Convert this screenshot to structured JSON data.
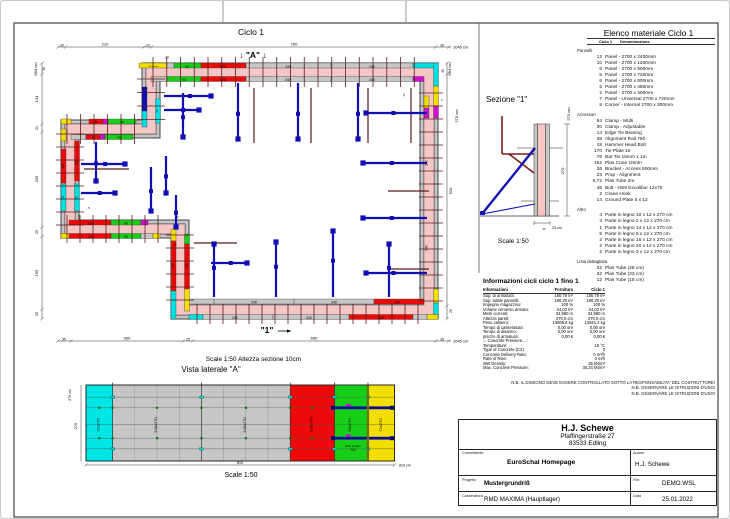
{
  "plan": {
    "title": "Ciclo 1",
    "scale_line": "Scale 1:50   Altezza sezione 10cm",
    "vista_title": "Vista laterale \"A\"",
    "labels": [
      {
        "x": 61,
        "y": 45.5,
        "t": "20",
        "s": 3.4
      },
      {
        "x": 104,
        "y": 44.5,
        "t": "210",
        "s": 4
      },
      {
        "x": 147,
        "y": 45.5,
        "t": "20",
        "s": 3.4
      },
      {
        "x": 293,
        "y": 44.5,
        "t": "760",
        "s": 4
      },
      {
        "x": 441,
        "y": 45.5,
        "t": "35",
        "s": 3.4
      },
      {
        "x": 452,
        "y": 47.5,
        "t": "1045 cm",
        "s": 4,
        "a": "s"
      },
      {
        "x": 252,
        "y": 57,
        "t": "↓ \"A\" ↓",
        "s": 8.5,
        "w": "b"
      },
      {
        "x": 166,
        "y": 57.5,
        "t": "10",
        "s": 3.4
      },
      {
        "x": 36,
        "y": 68,
        "t": "684 cm",
        "s": 4,
        "r": 1
      },
      {
        "x": 44,
        "y": 68,
        "t": "30",
        "s": 3.2,
        "r": 1
      },
      {
        "x": 37,
        "y": 98,
        "t": "134",
        "s": 4,
        "r": 1
      },
      {
        "x": 37,
        "y": 127,
        "t": "20",
        "s": 3.4,
        "r": 1
      },
      {
        "x": 37,
        "y": 178,
        "t": "255",
        "s": 4,
        "r": 1
      },
      {
        "x": 37,
        "y": 231,
        "t": "25",
        "s": 3.4,
        "r": 1
      },
      {
        "x": 37,
        "y": 272,
        "t": "195",
        "s": 4,
        "r": 1
      },
      {
        "x": 37,
        "y": 313,
        "t": "25",
        "s": 3.4,
        "r": 1
      },
      {
        "x": 450,
        "y": 68,
        "t": "684 cm",
        "s": 4,
        "r": 1
      },
      {
        "x": 443,
        "y": 70,
        "t": "30",
        "s": 3.2,
        "r": 1
      },
      {
        "x": 457,
        "y": 115,
        "t": "270 cm",
        "s": 4,
        "r": 1
      },
      {
        "x": 451,
        "y": 190,
        "t": "620",
        "s": 4,
        "r": 1
      },
      {
        "x": 451,
        "y": 310,
        "t": "25",
        "s": 3.4,
        "r": 1
      },
      {
        "x": 63,
        "y": 339.5,
        "t": "35",
        "s": 3.4
      },
      {
        "x": 126,
        "y": 338.5,
        "t": "300",
        "s": 4
      },
      {
        "x": 187,
        "y": 339.5,
        "t": "25",
        "s": 3.4
      },
      {
        "x": 313,
        "y": 338.5,
        "t": "650",
        "s": 4
      },
      {
        "x": 441,
        "y": 339.5,
        "t": "35",
        "s": 3.4
      },
      {
        "x": 452,
        "y": 341.5,
        "t": "1045 cm",
        "s": 4,
        "a": "s"
      },
      {
        "x": 266,
        "y": 332,
        "t": "\"1\"",
        "s": 8.5,
        "w": "b"
      },
      {
        "x": 287,
        "y": 66.8,
        "t": "240",
        "s": 3.4
      },
      {
        "x": 371,
        "y": 66.8,
        "t": "240",
        "s": 3.4
      },
      {
        "x": 222,
        "y": 66.8,
        "t": "120",
        "s": 3.4
      },
      {
        "x": 186,
        "y": 66.8,
        "t": "90",
        "s": 3.4
      },
      {
        "x": 287,
        "y": 79.8,
        "t": "240",
        "s": 3.4
      },
      {
        "x": 371,
        "y": 79.8,
        "t": "240",
        "s": 3.4
      },
      {
        "x": 222,
        "y": 79.8,
        "t": "120",
        "s": 3.4
      },
      {
        "x": 183,
        "y": 79.8,
        "t": "90",
        "s": 3.4
      },
      {
        "x": 234,
        "y": 318.2,
        "t": "240",
        "s": 3.4
      },
      {
        "x": 308,
        "y": 318.2,
        "t": "240",
        "s": 3.4
      },
      {
        "x": 380,
        "y": 318.2,
        "t": "120",
        "s": 3.4
      },
      {
        "x": 253,
        "y": 302.5,
        "t": "240",
        "s": 3.4
      },
      {
        "x": 333,
        "y": 302.5,
        "t": "240",
        "s": 3.4
      },
      {
        "x": 396,
        "y": 302.5,
        "t": "120",
        "s": 3.4
      },
      {
        "x": 426.5,
        "y": 162,
        "t": "240",
        "s": 3.4,
        "r": 1
      },
      {
        "x": 426.5,
        "y": 247,
        "t": "240",
        "s": 3.4,
        "r": 1
      },
      {
        "x": 89,
        "y": 223.5,
        "t": "120",
        "s": 3.2
      },
      {
        "x": 125,
        "y": 223.5,
        "t": "90",
        "s": 3.2
      },
      {
        "x": 89,
        "y": 237,
        "t": "120",
        "s": 3.2
      },
      {
        "x": 125,
        "y": 237,
        "t": "90",
        "s": 3.2
      },
      {
        "x": 63,
        "y": 165,
        "t": "120",
        "s": 3.2,
        "r": 1
      },
      {
        "x": 76.5,
        "y": 162,
        "t": "120",
        "s": 3.2,
        "r": 1
      },
      {
        "x": 63,
        "y": 197,
        "t": "72",
        "s": 3.2,
        "r": 1
      },
      {
        "x": 76.5,
        "y": 197,
        "t": "72",
        "s": 3.2,
        "r": 1
      },
      {
        "x": 173,
        "y": 265,
        "t": "120",
        "s": 3.2,
        "r": 1
      },
      {
        "x": 186.5,
        "y": 265,
        "t": "120",
        "s": 3.2,
        "r": 1
      },
      {
        "x": 95,
        "y": 122,
        "t": "45",
        "s": 3
      },
      {
        "x": 121,
        "y": 122,
        "t": "90",
        "s": 3
      },
      {
        "x": 92,
        "y": 137.3,
        "t": "45",
        "s": 3
      },
      {
        "x": 118,
        "y": 137.3,
        "t": "90",
        "s": 3
      },
      {
        "x": 404,
        "y": 94,
        "t": "14",
        "s": 3,
        "r": 1
      },
      {
        "x": 441,
        "y": 100,
        "t": "2",
        "s": 3
      },
      {
        "x": 176,
        "y": 217,
        "t": "26",
        "s": 3
      },
      {
        "x": 88,
        "y": 208,
        "t": "5",
        "s": 3
      },
      {
        "x": 174,
        "y": 244.5,
        "t": "20",
        "s": 3
      },
      {
        "x": 157,
        "y": 110,
        "t": "72",
        "s": 3,
        "r": 1
      },
      {
        "x": 152,
        "y": 65.8,
        "t": "Universal",
        "s": 2.2
      }
    ]
  },
  "sezione": {
    "title": "Sezione \"1\"",
    "scale": "Scale 1:50",
    "labels": [
      {
        "x": 569,
        "y": 113,
        "t": "270 cm",
        "s": 4,
        "r": 1
      },
      {
        "x": 563,
        "y": 170,
        "t": "270",
        "s": 4,
        "r": 1
      },
      {
        "x": 551,
        "y": 228,
        "t": "25 cm",
        "s": 3.6,
        "a": "s"
      },
      {
        "x": 543,
        "y": 229,
        "t": "35",
        "s": 2.8
      }
    ]
  },
  "side_view": {
    "panels": [
      {
        "w": 72,
        "label": "72x270",
        "color": "#00e6e6"
      },
      {
        "w": 240,
        "label": "240x270",
        "color": "#c6c6c6",
        "sub": true
      },
      {
        "w": 240,
        "label": "240x270",
        "color": "#c6c6c6",
        "sub": true
      },
      {
        "w": 120,
        "label": "120x270",
        "color": "#ee0909"
      },
      {
        "w": 90,
        "label": "90x270",
        "color": "#17cf17"
      },
      {
        "w": 72,
        "label": "72x270",
        "color": "#f2de00"
      }
    ],
    "scale": "Scale 1:50",
    "labels": [
      {
        "x": 98.3,
        "y": 424,
        "t": "72x270",
        "s": 4,
        "r": 1
      },
      {
        "x": 156,
        "y": 424,
        "t": "240x270",
        "s": 4,
        "r": 1
      },
      {
        "x": 244.8,
        "y": 424,
        "t": "240x270",
        "s": 4,
        "r": 1
      },
      {
        "x": 311.4,
        "y": 424,
        "t": "120x270",
        "s": 4,
        "r": 1
      },
      {
        "x": 350.2,
        "y": 424,
        "t": "90x270",
        "s": 4,
        "r": 1
      },
      {
        "x": 381.2,
        "y": 424,
        "t": "72x270",
        "s": 4,
        "r": 1
      },
      {
        "x": 70,
        "y": 394,
        "t": "270 cm",
        "s": 3.6,
        "r": 1
      },
      {
        "x": 76,
        "y": 425,
        "t": "270",
        "s": 3.8,
        "r": 1
      },
      {
        "x": 239,
        "y": 462.8,
        "t": "810",
        "s": 3.6
      },
      {
        "x": 398,
        "y": 465.5,
        "t": "810 cm",
        "s": 3.6,
        "a": "s"
      },
      {
        "x": 352,
        "y": 446,
        "t": "Parte in legno",
        "s": 2.6
      },
      {
        "x": 352,
        "y": 449.5,
        "t": "3x12",
        "s": 2.6
      }
    ]
  },
  "materials": {
    "title": "Elenco materiale  Ciclo 1",
    "col1": "Ciclo 1",
    "col2": "Denominazione",
    "sections": [
      {
        "name": "Pannelli",
        "items": [
          [
            "12",
            "Panel - 2700 x 2400mm"
          ],
          [
            "10",
            "Panel - 2700 x 1200mm"
          ],
          [
            "6",
            "Panel - 2700 x 900mm"
          ],
          [
            "6",
            "Panel - 2700 x 720mm"
          ],
          [
            "6",
            "Panel - 2700 x 600mm"
          ],
          [
            "5",
            "Panel - 2700 x 450mm"
          ],
          [
            "2",
            "Panel - 2700 x 300mm"
          ],
          [
            "7",
            "Panel - Universal 2700 x 720mm"
          ],
          [
            "8",
            "Corner - Internal 2700 x 300mm"
          ]
        ]
      },
      {
        "name": "Accessori",
        "items": [
          [
            "84",
            "Clamp - Multi"
          ],
          [
            "30",
            "Clamp - Adjustable"
          ],
          [
            "14",
            "Edge Tie Bearing"
          ],
          [
            "38",
            "Alignment Rail 750"
          ],
          [
            "18",
            "Hammer Head Bolt"
          ],
          [
            "170",
            "Tie Plate 15"
          ],
          [
            "76",
            "Bar Tie 15mm x 1m"
          ],
          [
            "152",
            "Plas Cone 10mm"
          ],
          [
            "36",
            "Bracket - Access 900mm"
          ],
          [
            "23",
            "Prop - Alignment"
          ],
          [
            "9,72",
            "Plas Tube 2m"
          ],
          [
            "46",
            "Bolt - HS9 Excalibur 12x75"
          ],
          [
            "2",
            "Crane Hook"
          ],
          [
            "14",
            "Ground Plate 5 x 12"
          ]
        ]
      },
      {
        "name": "Altro",
        "items": [
          [
            "4",
            "Parte in legno 10 x 12 x 270 cm"
          ],
          [
            "3",
            "Parte in legno 2 x 12 x 270 cm"
          ],
          [
            "1",
            "Parte in legno 14 x 12 x 270 cm"
          ],
          [
            "5",
            "Parte in legno 5 x 12 x 270 cm"
          ],
          [
            "2",
            "Parte in legno 16 x 12 x 270 cm"
          ],
          [
            "2",
            "Parte in legno 20 x 12 x 270 cm"
          ],
          [
            "2",
            "Parte in legno 3 x 12 x 270 cm"
          ]
        ]
      },
      {
        "name": "Lista dettagliata",
        "items": [
          [
            "32",
            "Plas Tube  (28 cm)"
          ],
          [
            "32",
            "Plas Tube  (23 cm)"
          ],
          [
            "12",
            "Plas Tube  (18 cm)"
          ]
        ]
      }
    ]
  },
  "info": {
    "title": "Informazioni cicli  ciclo 1 fino 1",
    "cols": [
      "Informazioni",
      "Fornitura",
      "Ciclo 1"
    ],
    "rows": [
      [
        "Sup. di armatura:",
        "180,79 m²",
        "180,79 m²"
      ],
      [
        "Sup. totale pannelli:",
        "180,30 m²",
        "180,30 m²"
      ],
      [
        "Impegno magazzino:",
        "100 %",
        "100 %"
      ],
      [
        "Volume cemento armato:",
        "24,02 m³",
        "24,02 m³"
      ],
      [
        "Metri correnti:",
        "34,580 m",
        "34,580 m"
      ],
      [
        "Altezza pareti:",
        "270,0 cm",
        "270,0 cm"
      ],
      [
        "Peso cassero:",
        "13665,8 kg",
        "13941,3 kg"
      ],
      [
        "Tempo di casseratura:",
        "0,00 ore",
        "0,00 ore"
      ],
      [
        "Tempo di disarmo:",
        "0,00 ore",
        "0,00 ore"
      ],
      [
        "prezzo di armatura:",
        "0,00 €",
        "0,00 €"
      ],
      [
        "... Concrete Pressure ...:",
        "",
        ""
      ],
      [
        "Temperature:",
        "",
        "15 °C"
      ],
      [
        "Type of Concrete (C2):",
        "",
        "0"
      ],
      [
        "Concrete Delivery Rate:",
        "",
        "0 m³/h"
      ],
      [
        "Rate of Rise:",
        "",
        "0 m/h"
      ],
      [
        "Wet Density:",
        "",
        "25 kN/m³"
      ],
      [
        "Max. Concrete Pressure:",
        "",
        "30,24 kN/m²"
      ]
    ]
  },
  "notes": [
    "N.B. IL DISEGNO DEVE ESSERE CONTROLLATO SOTTO LA RESPONSABILITA' DEL COSTRUTTORE!",
    "N.B. OSSERVARE LE ISTRUZIONI D'USO!",
    "N.B. OSSERVARE LE ISTRUZIONI D'USO!"
  ],
  "title_block": {
    "name": "H.J. Schewe",
    "addr1": "Pfaffingerstraße 27",
    "addr2": "83533 Edling",
    "committente_label": "Committente",
    "committente": "EuroSchal Homepage",
    "autore_label": "Autore",
    "autore": "H.J. Schewe",
    "progetto_label": "Progetto",
    "progetto": "Mustergrundriß",
    "file_label": "File.",
    "file": "DEMO.WSL",
    "casseratura_label": "Casseratura",
    "casseratura": "RMD MAXIMA (Hauptlager)",
    "data_label": "Data",
    "data": "25.01.2022"
  },
  "colors": {
    "concrete_pink": "#f5c6c6",
    "formwork_gray": "#c6c6c6",
    "panel_red": "#ee0909",
    "panel_green": "#17cf17",
    "panel_cyan": "#00e0e0",
    "panel_yellow": "#f2de00",
    "panel_magenta": "#cf10cf",
    "prop_blue": "#0f0fb4",
    "tie_brown": "#5a1a1a"
  }
}
